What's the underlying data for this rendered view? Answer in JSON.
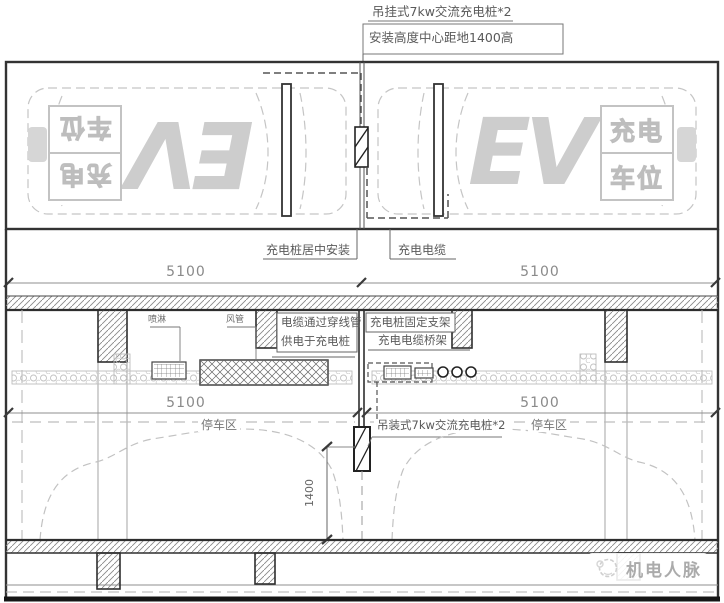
{
  "drawing": {
    "top_annotations": {
      "line1": "吊挂式7kw交流充电桩*2",
      "line2": "安装高度中心距地1400高"
    },
    "plan": {
      "marking_line1": "充电",
      "marking_line2": "车位",
      "ev_text": "EV",
      "label_pile_center": "充电桩居中安装",
      "label_cable": "充电电缆",
      "dim_left": "5100",
      "dim_right": "5100"
    },
    "section": {
      "label_sprinkler": "喷淋",
      "label_duct": "风管",
      "label_conduit_line1": "电缆通过穿线管",
      "label_conduit_line2": "供电于充电桩",
      "label_bracket": "充电桩固定支架",
      "label_tray": "充电电缆桥架",
      "dim_left": "5100",
      "dim_right": "5100",
      "label_pile": "吊装式7kw交流充电桩*2",
      "label_parking_left": "停车区",
      "label_parking_right": "停车区",
      "dim_height": "1400"
    },
    "watermark": {
      "text": "机电人脉"
    },
    "colors": {
      "line": "#3f3f3f",
      "dim_text": "#8a8a8a",
      "marking": "#cdcdcd",
      "annotation": "#5a5a5a"
    }
  }
}
